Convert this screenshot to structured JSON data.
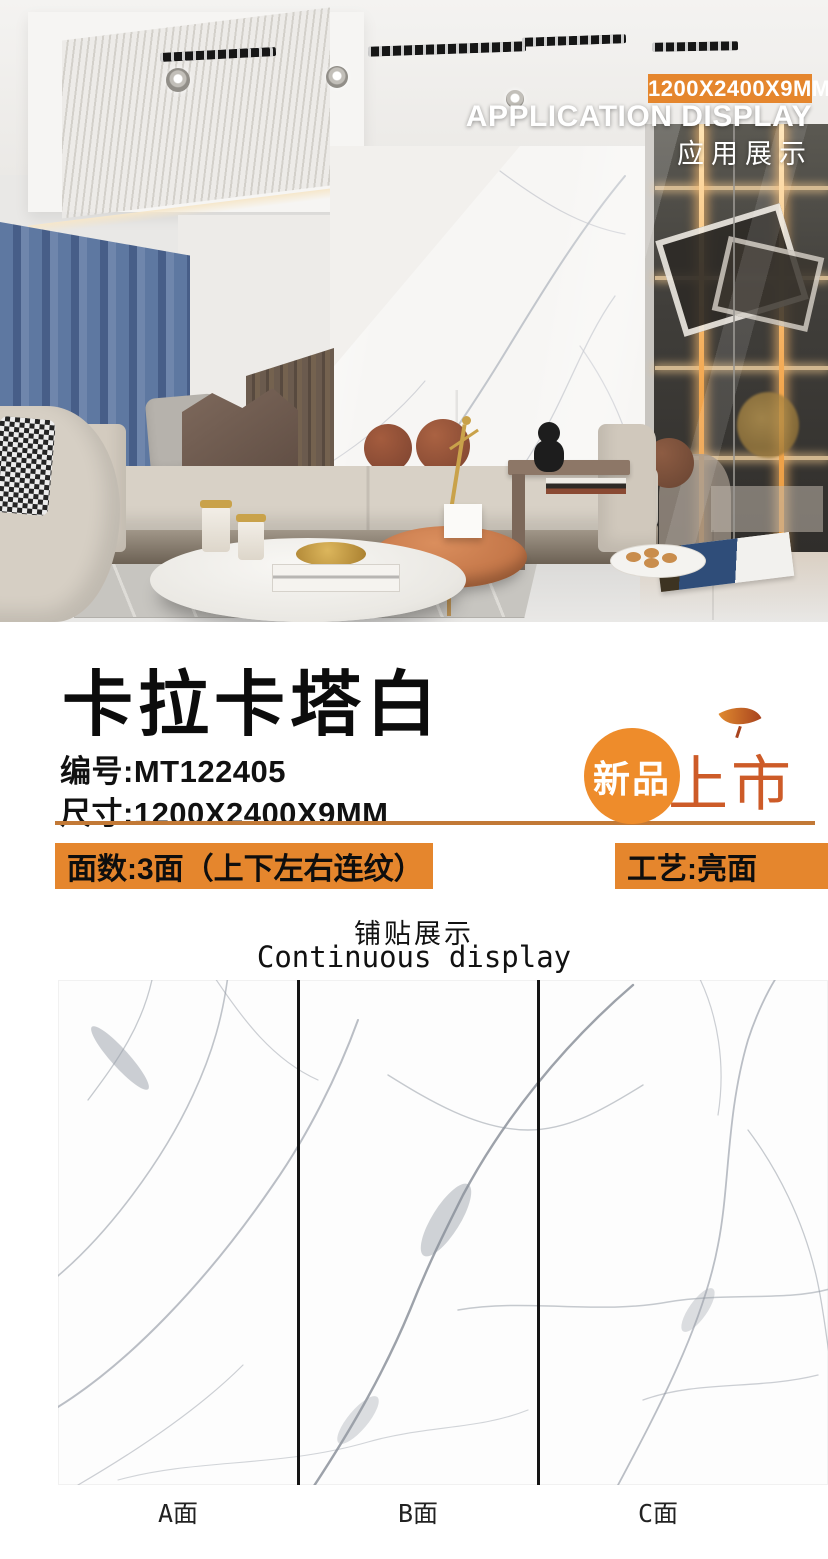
{
  "photo": {
    "badge": "1200X2400X9MM",
    "heading_en": "APPLICATION DISPLAY",
    "heading_cn": "应用展示"
  },
  "product": {
    "name": "卡拉卡塔白",
    "code_line": "编号:MT122405",
    "size_line": "尺寸:1200X2400X9MM",
    "faces_line": "面数:3面（上下左右连纹）",
    "craft_line": "工艺:亮面",
    "new_badge": {
      "circle": "新品",
      "suffix": "上市"
    }
  },
  "tiling": {
    "heading_cn": "铺贴展示",
    "heading_en": "Continuous display",
    "labels": [
      "A面",
      "B面",
      "C面"
    ]
  },
  "colors": {
    "accent_orange": "#E5862D",
    "divider_orange": "#C27936",
    "badge_circle_orange": "#EE8C2B",
    "badge_text_orange": "#CD5B28",
    "panel_divider_black": "#141414",
    "vein_gray": "#8E95A0"
  }
}
